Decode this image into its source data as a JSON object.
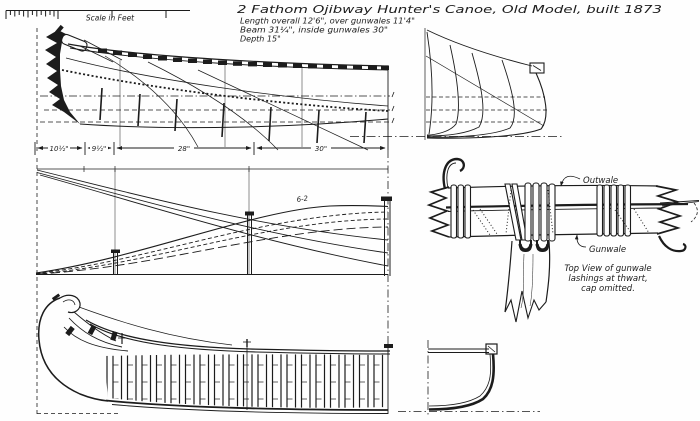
{
  "colors": {
    "ink": "#1c1c1c",
    "paper": "#fefefe"
  },
  "scale_bar": {
    "label": "Scale in Feet"
  },
  "title_block": {
    "title": "2 Fathom Ojibway Hunter's Canoe, Old Model, built 1873",
    "spec_line1": "Length overall 12'6\", over gunwales 11'4\"",
    "spec_line2": "Beam 31¼\", inside gunwales 30\"",
    "spec_line3": "Depth 15\""
  },
  "profile_dimensions": {
    "seg1": "10½\"",
    "seg2": "9½\"",
    "seg3": "28\"",
    "seg4": "30\""
  },
  "plan_view": {
    "station_label": "6-2"
  },
  "lashing_detail": {
    "outwale_label": "Outwale",
    "gunwale_label": "Gunwale",
    "caption_line1": "Top View of gunwale",
    "caption_line2": "lashings at thwart,",
    "caption_line3": "cap omitted."
  }
}
